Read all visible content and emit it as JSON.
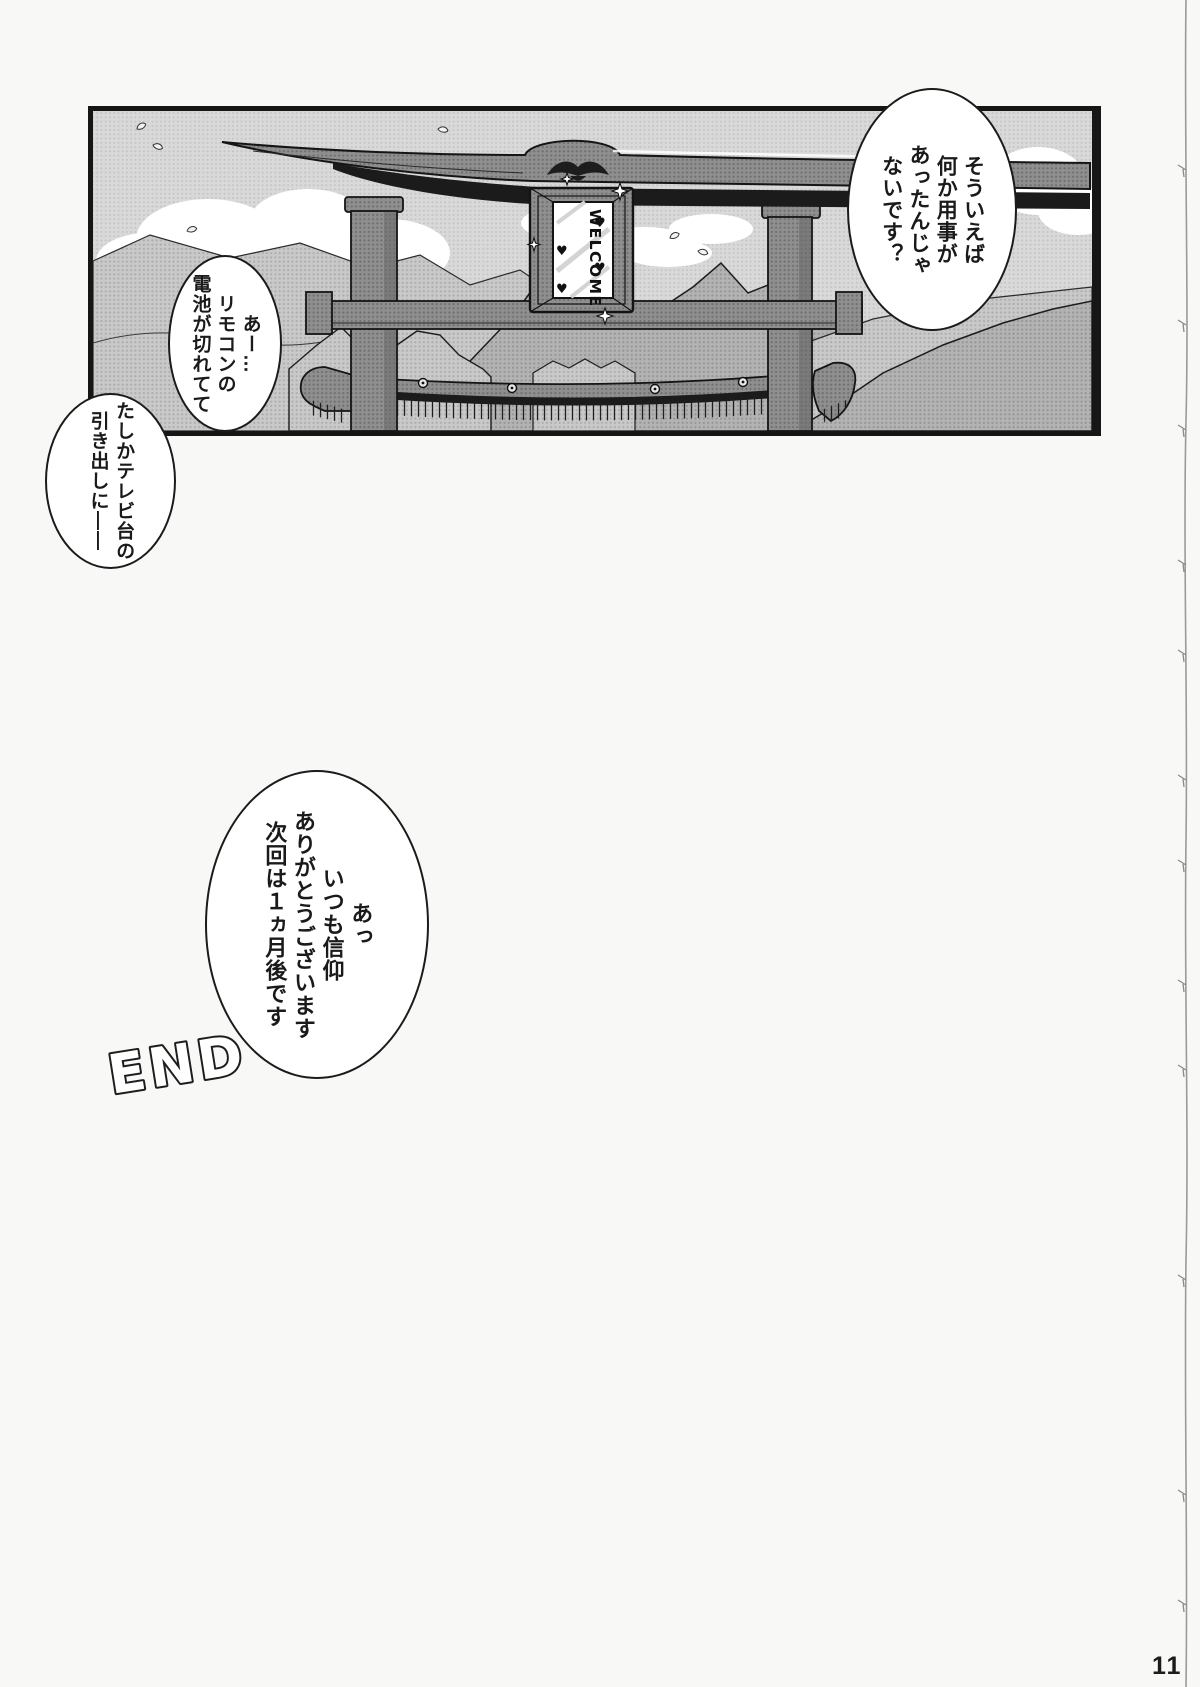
{
  "page": {
    "number": "11"
  },
  "panel": {
    "bubbles": [
      {
        "text": "そういえば\n何か用事が\nあったんじゃ\nないです？"
      },
      {
        "text": "あー…\nリモコンの\n電池が切れてて"
      },
      {
        "text": "たしかテレビ台の\n引き出しに――"
      },
      {
        "text": "あっ\nいつも信仰\nありがとうございます\n次回は１ヵ月後です"
      }
    ],
    "sign": {
      "text": "WELCOME",
      "heart": "♥"
    },
    "end_label": "END"
  },
  "colors": {
    "ink": "#161616",
    "sky_tone": "#d8d8d8",
    "paper": "#f8f8f6"
  }
}
